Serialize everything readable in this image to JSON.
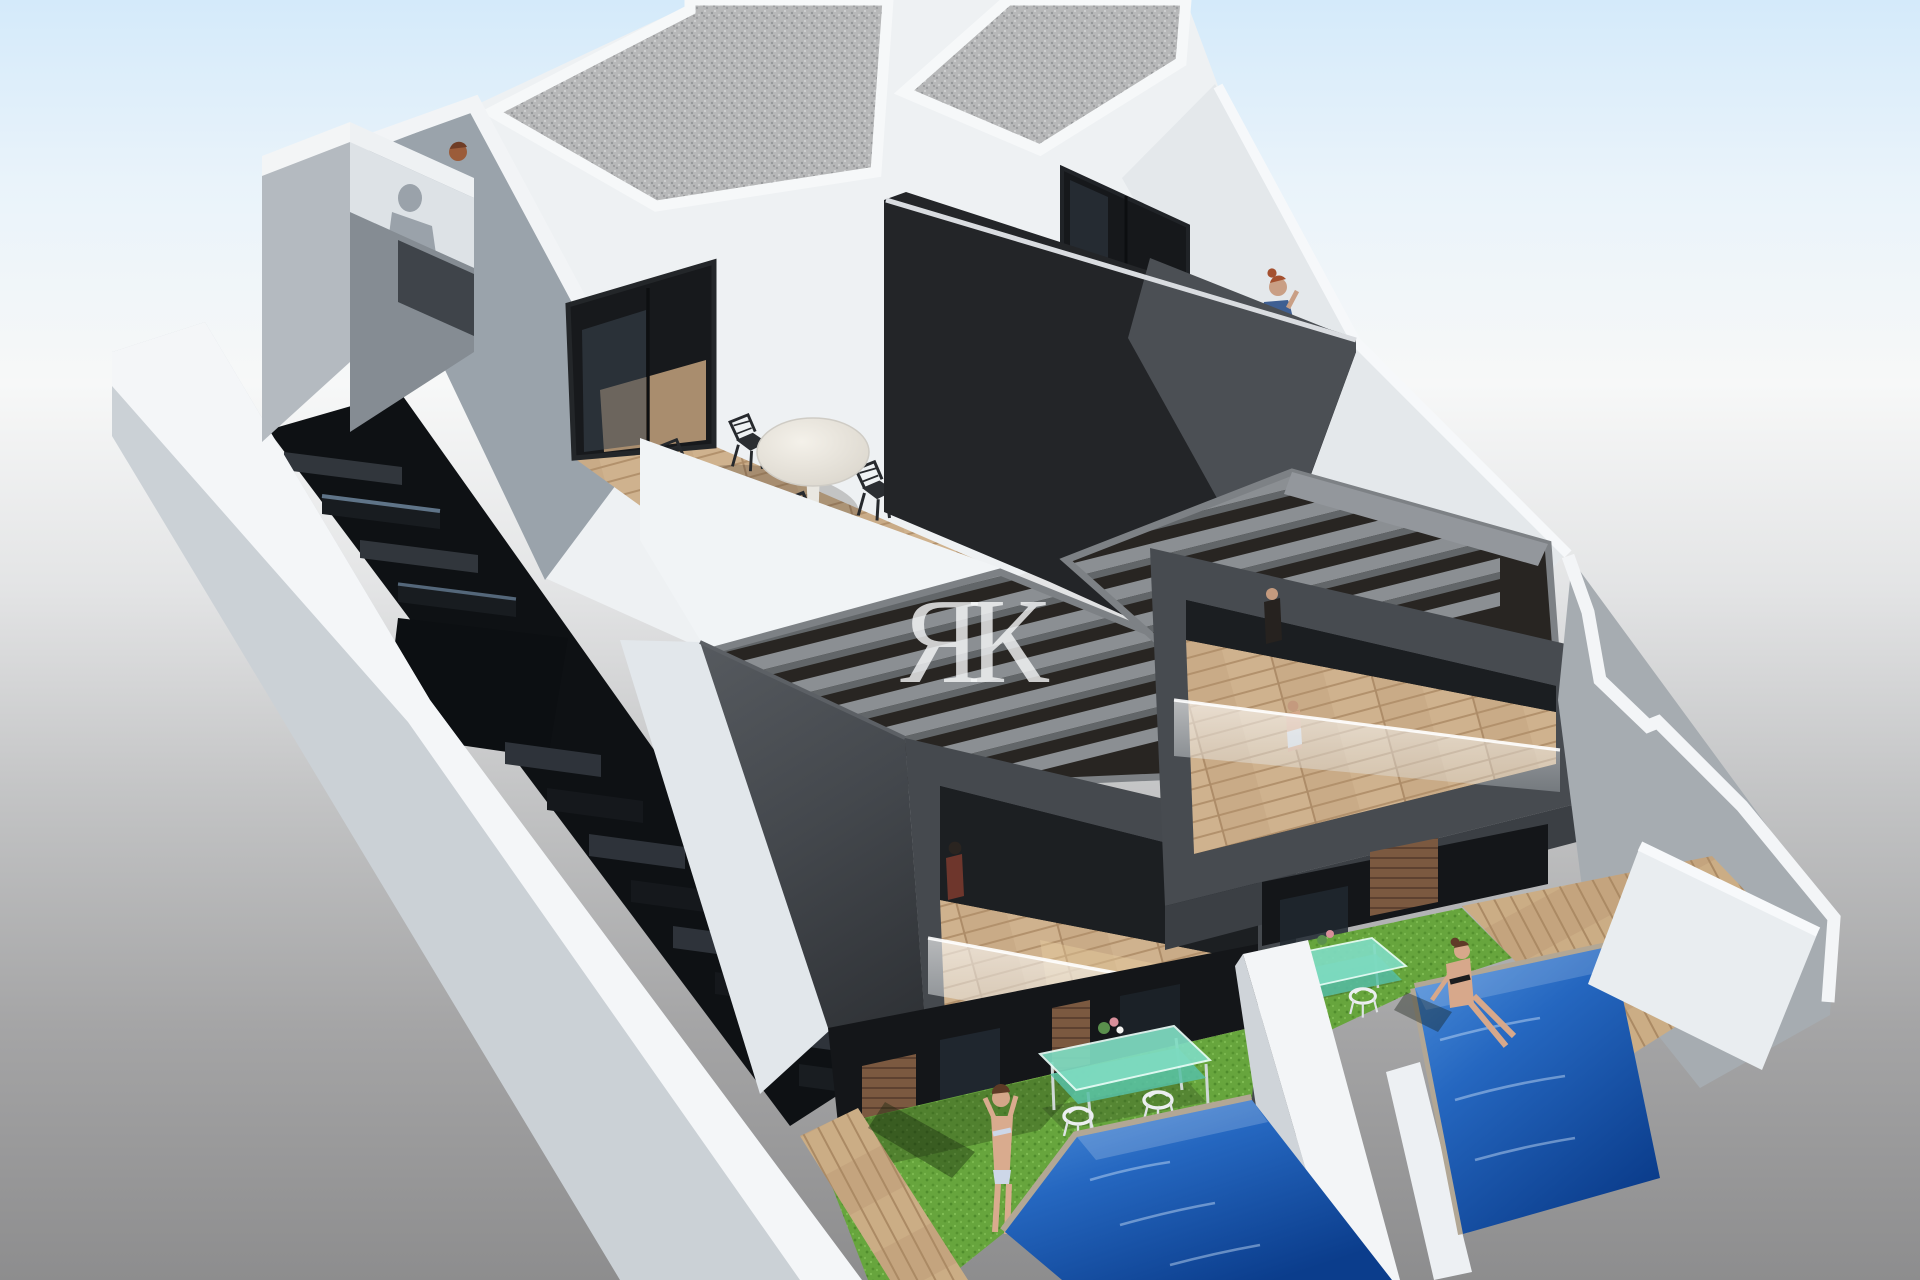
{
  "meta": {
    "type": "3d-architectural-render",
    "width_px": 1920,
    "height_px": 1280
  },
  "watermark": {
    "text": "ЯК"
  },
  "palette": {
    "sky_top": "#d4eafa",
    "haze_mid": "#f7f8f8",
    "ground_bottom": "#8d8d8e",
    "building_white": "#eef1f3",
    "wall_light": "#d9dee2",
    "wall_shaded_blue_gray": "#9aa3ab",
    "charcoal_volume": "#3e4247",
    "party_wall_dark": "#232528",
    "pergola_beam": "#8b8f93",
    "terrace_wood": "#c7a987",
    "gravel_roof": "#b7b8b9",
    "grass_green": "#67a53d",
    "pool_blue": "#1e5cb4",
    "glass_table_teal": "#7fdcc2",
    "wood_slat_wall": "#7b5940",
    "skin_tone": "#d6a88c",
    "dress_blue": "#3f5f92",
    "hair_red": "#a4502f"
  },
  "scene": {
    "subject": "two-unit modern duplex villa, aerial three-quarter view",
    "units": 2,
    "features": [
      "gravel flat roofs",
      "roof terraces with round marble tables and wire chairs",
      "gray slatted pergolas over first-floor balconies",
      "frameless glass balustrades",
      "dark party wall between units",
      "side open-riser staircase between white walls",
      "private gardens with artificial grass",
      "teal glass dining tables with white chairs",
      "two blue plunge pools",
      "timber slat accent walls",
      "white boundary walls"
    ],
    "people": [
      "man's head peeking over the stair-entry parapet",
      "woman in blue dress on the right roof terrace",
      "woman in bikini standing on the left lawn",
      "woman in black bikini sitting on the right pool edge",
      "small resident figures inside both balconies"
    ]
  }
}
